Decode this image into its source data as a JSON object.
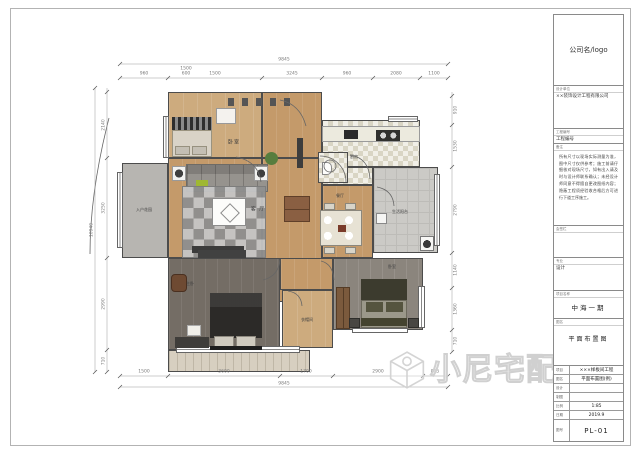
{
  "titleblock": {
    "logo": "公司名/logo",
    "s2_label": "设计单位",
    "s2_value": "××装饰设计工程有限公司",
    "s3_label": "工程编号",
    "s3_value": "工程编号",
    "notes_label": "备注",
    "notes": "所有尺寸以现场实际测量为准，图中尺寸仅供参考；施工前请仔细核对现场尺寸，如有出入请及时与设计师联系确认；未经设计师同意不得擅自更改图纸内容；隐蔽工程须经验收合格后方可进行下道工序施工。",
    "s5_label": "会签栏",
    "s6_label": "专业",
    "s6_value": "设计",
    "s7_label": "项目名称",
    "s7_value": "中海一期",
    "s8_label": "图名",
    "s8_value": "平面布置图",
    "rows": [
      {
        "label": "项目",
        "value": "×××样板间工程"
      },
      {
        "label": "图名",
        "value": "平面布置图(例)"
      },
      {
        "label": "设计",
        "value": ""
      },
      {
        "label": "制图",
        "value": ""
      },
      {
        "label": "比例",
        "value": "1:85"
      },
      {
        "label": "日期",
        "value": "2019.9"
      },
      {
        "label": "图号",
        "value": "PL-01"
      }
    ]
  },
  "rooms": {
    "bedroom_tl": "卧室",
    "living": "客 厅",
    "entry": "入户花园",
    "kitchen": "厨房",
    "laundry": "生活阳台",
    "dining": "餐厅",
    "master": "主卧",
    "cloak": "衣帽间",
    "bedroom_br": "卧室"
  },
  "dims": {
    "top": {
      "overall": "9845",
      "segments": [
        "960",
        "1500",
        "3245",
        "960",
        "2080",
        "1100"
      ],
      "stack1": "1500",
      "stack2": "600"
    },
    "bottom": {
      "overall": "9845",
      "segments": [
        "1500",
        "3600",
        "1700",
        "2900",
        "845"
      ]
    },
    "left": {
      "overall": "10940",
      "segments": [
        "2140",
        "3250",
        "2990",
        "710"
      ]
    },
    "right": {
      "segments": [
        "910",
        "1530",
        "2790",
        "1140",
        "1360",
        "710"
      ]
    }
  },
  "watermark": {
    "text": "小尼宅配"
  }
}
